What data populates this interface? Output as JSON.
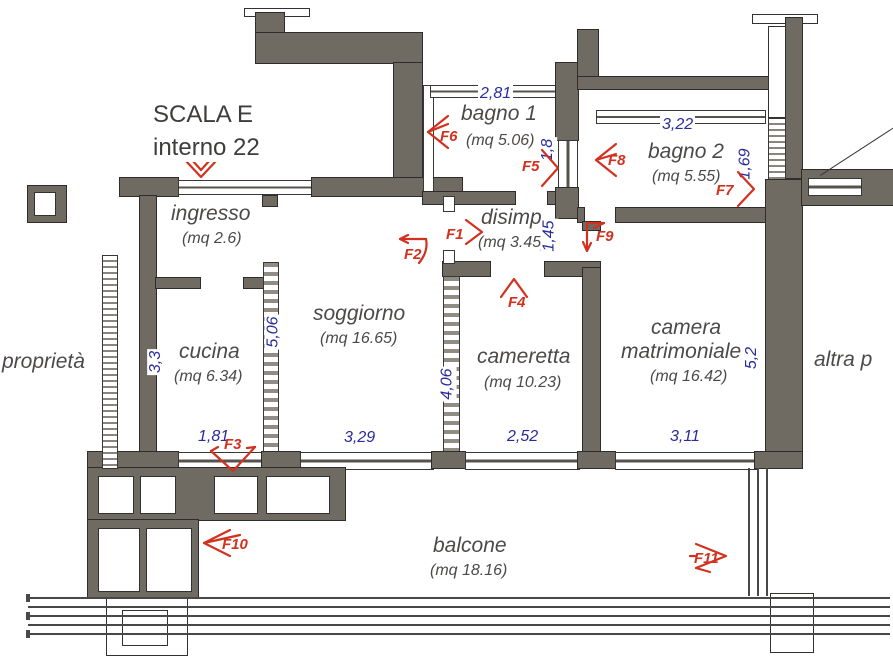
{
  "header": {
    "scala": "SCALA E",
    "interno": "interno 22"
  },
  "neighbors": {
    "left": "proprietà",
    "right": "altra p"
  },
  "colors": {
    "wall": "#6f6a62",
    "dimension_text": "#2a2a9c",
    "marker_text": "#d2311f",
    "room_text": "#4c4a48"
  },
  "rooms": [
    {
      "id": "ingresso",
      "name": "ingresso",
      "area": "(mq 2.6)"
    },
    {
      "id": "cucina",
      "name": "cucina",
      "area": "(mq 6.34)"
    },
    {
      "id": "soggiorno",
      "name": "soggiorno",
      "area": "(mq 16.65)"
    },
    {
      "id": "bagno-1",
      "name": "bagno 1",
      "area": "(mq 5.06)"
    },
    {
      "id": "disimpegno",
      "name": "disimp.",
      "area": "(mq 3.45)"
    },
    {
      "id": "bagno-2",
      "name": "bagno 2",
      "area": "(mq 5.55)"
    },
    {
      "id": "cameretta",
      "name": "cameretta",
      "area": "(mq 10.23)"
    },
    {
      "id": "camera-matrimoniale",
      "name_line1": "camera",
      "name_line2": "matrimoniale",
      "area": "(mq 16.42)"
    },
    {
      "id": "balcone",
      "name": "balcone",
      "area": "(mq 18.16)"
    }
  ],
  "dimensions": {
    "bagno1_width": "2,81",
    "bagno1_depth": "1,8",
    "bagno2_width": "3,22",
    "bagno2_depth": "1,69",
    "disimpegno_depth": "1,45",
    "soggiorno_height": "5,06",
    "cucina_height": "3,3",
    "cucina_window": "1,81",
    "soggiorno_window": "3,29",
    "cameretta_height": "4,06",
    "cameretta_window": "2,52",
    "camera_window": "3,11",
    "camera_height": "5,2"
  },
  "markers": {
    "f1": "F1",
    "f2": "F2",
    "f3": "F3",
    "f4": "F4",
    "f5": "F5",
    "f6": "F6",
    "f7": "F7",
    "f8": "F8",
    "f9": "F9",
    "f10": "F10",
    "f11": "F11"
  }
}
